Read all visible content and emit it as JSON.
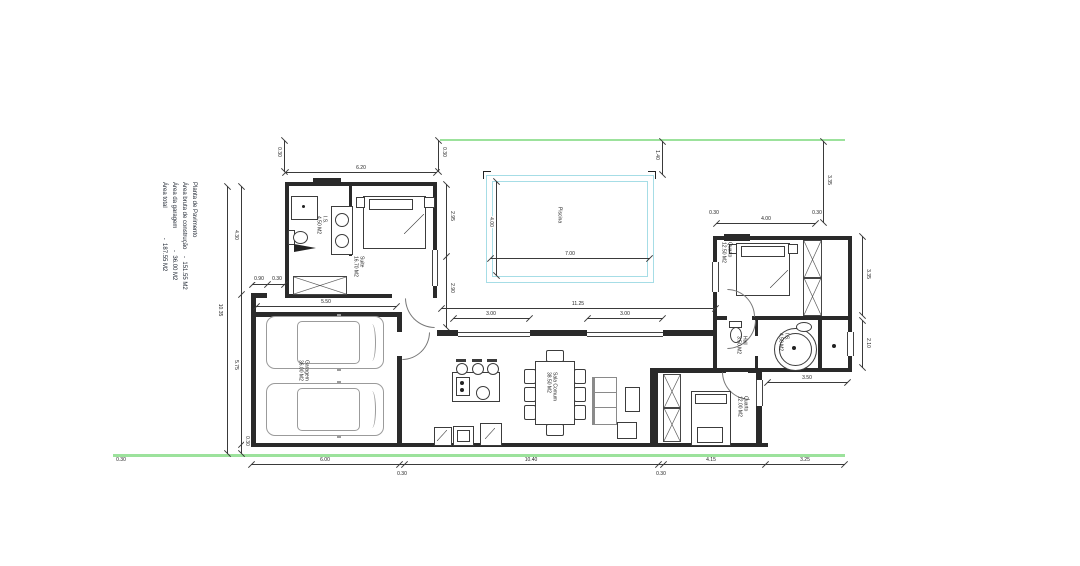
{
  "title_block": {
    "line1": "Planta de Pavimento",
    "line2": "Área bruta de construção    -  151.55 M2",
    "line3": "Área da garagem             -  36.00 M2",
    "line4": "Área total                  -  187.55 M2"
  },
  "rooms": {
    "pool": "Piscina",
    "suite": "Suite\n16.70 M2",
    "suite_bath": "I.S.\n4.50 M2",
    "bedroom1": "Quarto\n12.50 M2",
    "bedroom2": "Quarto\n12.00 M2",
    "hall": "Hall\n3.50 M2",
    "bath": "I.S.\n4.50 M2",
    "garage": "Garagem\n36.00 M2",
    "living": "Sala Comum\n38.50 M2"
  },
  "dims": {
    "left_total": "10.35",
    "left_seg1": "4.30",
    "left_seg2": "5.75",
    "left_seg3": "0.30",
    "suite_width": "6.20",
    "suite_wall_l": "0.30",
    "suite_wall_r": "0.30",
    "terrace_v1": "2.95",
    "terrace_v2": "2.90",
    "pool_w": "7.00",
    "pool_h": "4.00",
    "pool_setback": "1.40",
    "bed1_width": "4.00",
    "bed1_wall_l": "0.30",
    "bed1_wall_r": "0.30",
    "right_setback": "3.35",
    "right_v1": "3.35",
    "right_v2": "2.10",
    "bath_width": "3.50",
    "slider_left": "3.00",
    "slider_total": "11.25",
    "slider_right": "3.00",
    "garage_width": "5.50",
    "entry_door": "0.90",
    "entry_wall": "0.30",
    "bottom_seg1": "6.00",
    "bottom_seg2": "10.40",
    "bottom_seg3": "4.15",
    "bottom_seg4": "3.25",
    "bottom_sub1": "0.30",
    "bottom_sub2": "0.30",
    "bottom_left": "0.30"
  },
  "colors": {
    "wall": "#2a2a2a",
    "pool": "#a6dde6",
    "boundary": "#9ce29c",
    "car": "#9b9b9b",
    "dim": "#3a3a3a"
  }
}
